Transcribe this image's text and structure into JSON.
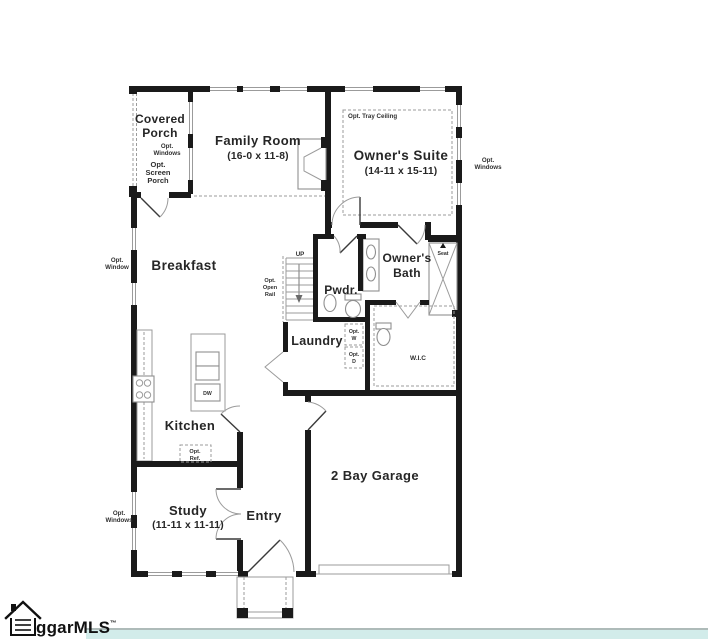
{
  "plan": {
    "rooms": {
      "covered_porch": {
        "lines": [
          "Covered",
          "Porch"
        ]
      },
      "family_room": {
        "name": "Family Room",
        "dims": "(16-0 x 11-8)"
      },
      "owners_suite": {
        "name": "Owner's Suite",
        "dims": "(14-11 x 15-11)"
      },
      "breakfast": {
        "name": "Breakfast"
      },
      "owners_bath": {
        "lines": [
          "Owner's",
          "Bath"
        ]
      },
      "pwdr": {
        "name": "Pwdr."
      },
      "laundry": {
        "name": "Laundry"
      },
      "wic": {
        "name": "W.I.C"
      },
      "kitchen": {
        "name": "Kitchen"
      },
      "study": {
        "name": "Study",
        "dims": "(11-11 x 11-11)"
      },
      "entry": {
        "name": "Entry"
      },
      "garage": {
        "name": "2 Bay Garage"
      }
    },
    "options": {
      "porch_windows": {
        "lines": [
          "Opt.",
          "Windows"
        ]
      },
      "screen_porch": {
        "lines": [
          "Opt.",
          "Screen",
          "Porch"
        ]
      },
      "tray_ceiling": {
        "label": "Opt. Tray Ceiling"
      },
      "suite_windows": {
        "lines": [
          "Opt.",
          "Windows"
        ]
      },
      "breakfast_window": {
        "lines": [
          "Opt.",
          "Window"
        ]
      },
      "study_windows": {
        "lines": [
          "Opt.",
          "Windows"
        ]
      },
      "open_rail": {
        "lines": [
          "Opt.",
          "Open",
          "Rail"
        ]
      },
      "washer": {
        "lines": [
          "Opt.",
          "W"
        ]
      },
      "dryer": {
        "lines": [
          "Opt.",
          "D"
        ]
      },
      "refrigerator": {
        "lines": [
          "Opt.",
          "Ref."
        ]
      }
    },
    "fixtures": {
      "stairs_direction": "UP",
      "shower_seat": "Seat",
      "dishwasher": "DW"
    }
  },
  "footer": {
    "logo_text": "ggarMLS",
    "trademark": "™",
    "bar_color": "#d2ecea"
  },
  "colors": {
    "wall": "#1a1a1a",
    "line_gray": "#9b9b9b",
    "text": "#262626"
  }
}
